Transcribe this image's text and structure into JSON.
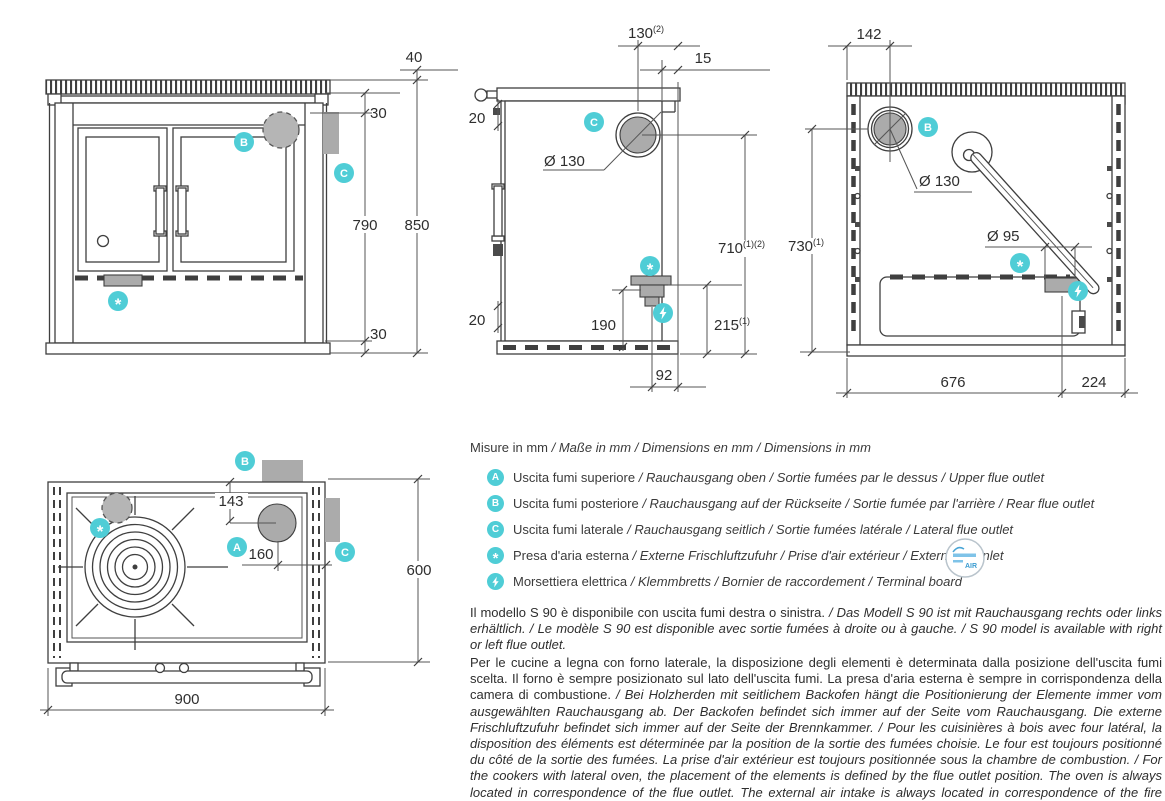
{
  "colors": {
    "accent_teal": "#4fcdd6",
    "drawing_line": "#3f3f3f",
    "gray_fill": "#ababab",
    "text": "#2e2e2e"
  },
  "markers": {
    "upper_flue": "A",
    "rear_flue": "B",
    "lateral_flue": "C",
    "air_inlet": "*"
  },
  "views": {
    "front": {
      "dims": {
        "worktop_thickness": "40",
        "top_gap": "30",
        "body_height": "790",
        "total_height": "850",
        "base_gap": "30"
      }
    },
    "side": {
      "dims": {
        "flue_center_offset": "130",
        "flue_center_offset_note": "(2)",
        "worktop_overhang": "15",
        "top_inset": "20",
        "flue_diameter": "Ø 130",
        "flue_center_height": "710",
        "flue_center_height_note": "(1)(2)",
        "air_inlet_height": "190",
        "terminal_height": "215",
        "terminal_height_note": "(1)",
        "bottom_inset": "20",
        "air_inlet_offset": "92"
      }
    },
    "rear": {
      "dims": {
        "flue_center_offset": "142",
        "flue_diameter": "Ø 130",
        "flue_center_height": "730",
        "flue_center_height_note": "(1)",
        "air_inlet_diameter": "Ø 95",
        "air_inlet_from_left": "676",
        "air_inlet_from_right": "224"
      }
    },
    "top": {
      "dims": {
        "flue_center_from_front": "143",
        "flue_center_from_side": "160",
        "width": "900",
        "depth": "600"
      }
    }
  },
  "legend": {
    "title_main": "Misure in mm",
    "title_rest": " / Maße in mm / Dimensions en mm / Dimensions in mm",
    "air_logo_text": "AIR",
    "items": [
      {
        "badge": "A",
        "main": "Uscita fumi superiore",
        "rest": " / Rauchausgang oben / Sortie fumées par le dessus / Upper flue outlet"
      },
      {
        "badge": "B",
        "main": "Uscita fumi posteriore",
        "rest": " / Rauchausgang auf der Rückseite / Sortie fumée par l'arrière / Rear flue outlet"
      },
      {
        "badge": "C",
        "main": "Uscita fumi laterale",
        "rest": " / Rauchausgang seitlich / Sortie fumées latérale / Lateral flue outlet"
      },
      {
        "badge": "*",
        "main": "Presa d'aria esterna",
        "rest": " / Externe Frischluftzufuhr / Prise d'air extérieur / External air inlet"
      },
      {
        "badge": "bolt",
        "main": "Morsettiera elettrica",
        "rest": " / Klemmbretts / Bornier de raccordement / Terminal board"
      }
    ]
  },
  "notes": [
    {
      "main": "Il modello S 90 è disponibile con uscita fumi destra o sinistra.",
      "rest": " / Das Modell S 90 ist mit Rauchausgang rechts oder links erhältlich. / Le modèle S 90 est disponible avec sortie fumées à droite ou à gauche. / S 90 model is available with right or left flue outlet."
    },
    {
      "main": "Per le cucine a legna con forno laterale, la disposizione degli elementi è determinata dalla posizione dell'uscita fumi scelta. Il forno è sempre posizionato sul lato dell'uscita fumi. La presa d'aria esterna è sempre in corrispondenza della camera di combustione.",
      "rest": " / Bei Holzherden mit seitlichem Backofen hängt die Positionierung der Elemente immer vom ausgewählten Rauchausgang ab. Der Backofen befindet sich immer auf der Seite vom Rauchausgang. Die externe Frischluftzufuhr befindet sich immer auf der Seite der Brennkammer. / Pour les cuisinières à bois avec four latéral, la disposition des éléments est déterminée par la position de la sortie des fumées choisie. Le four est toujours positionné du côté de la sortie des fumées. La prise d'air extérieur est toujours positionnée sous la chambre de combustion. / For the cookers with lateral oven, the placement of the elements is defined by the flue outlet position. The oven is always located in correspondence of the flue outlet. The external air intake is always located in correspondence of the fire chamber."
    }
  ]
}
